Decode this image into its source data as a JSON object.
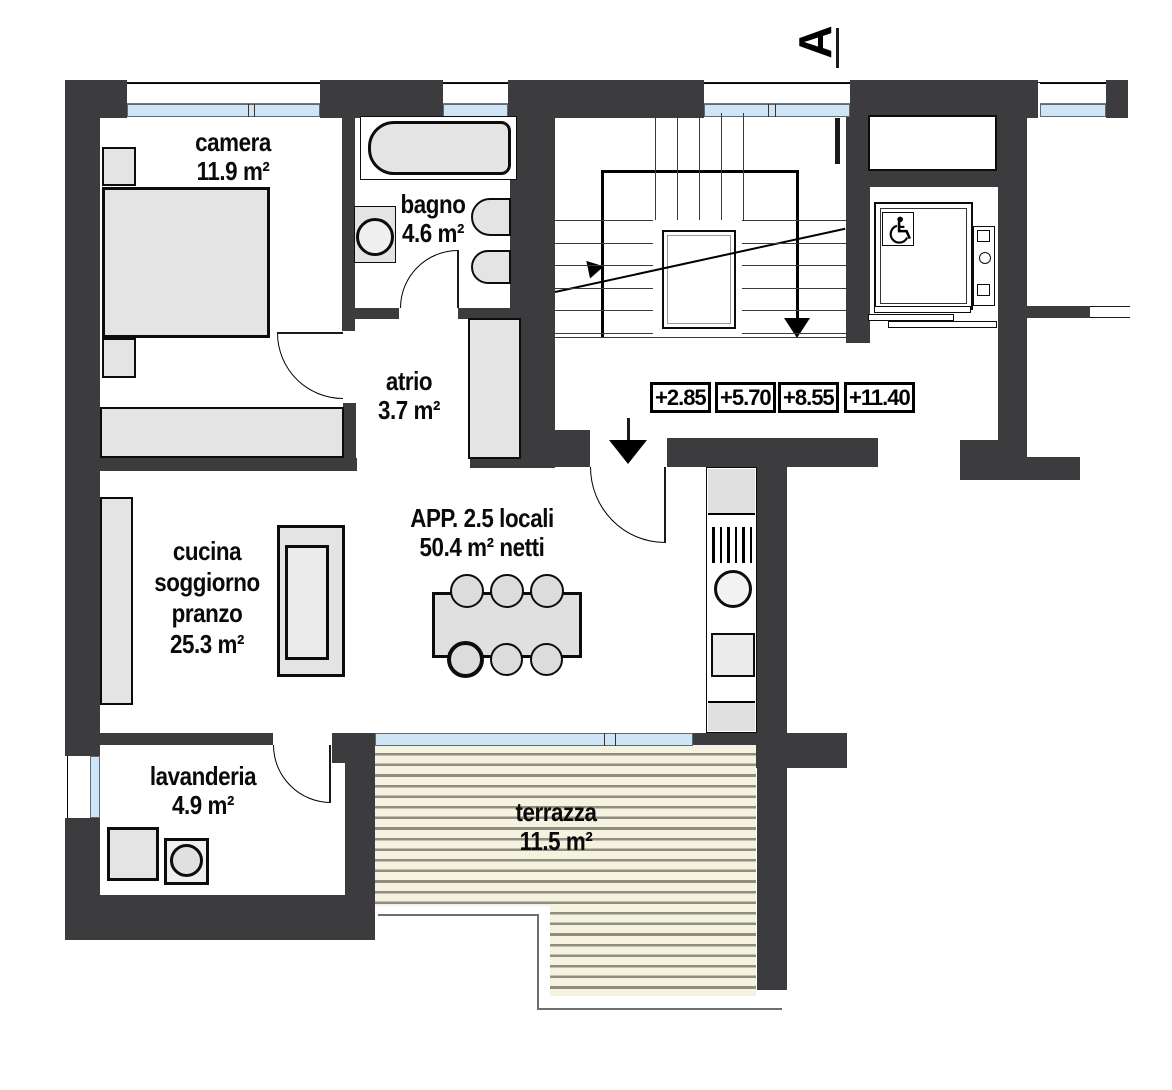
{
  "apartment": {
    "line1": "APP. 2.5 locali",
    "line2": "50.4 m² netti"
  },
  "rooms": {
    "camera": {
      "name": "camera",
      "area": "11.9 m²"
    },
    "bagno": {
      "name": "bagno",
      "area": "4.6 m²"
    },
    "atrio": {
      "name": "atrio",
      "area": "3.7 m²"
    },
    "cucina": {
      "line1": "cucina",
      "line2": "soggiorno",
      "line3": "pranzo",
      "area": "25.3 m²"
    },
    "lavanderia": {
      "name": "lavanderia",
      "area": "4.9 m²"
    },
    "terrazza": {
      "name": "terrazza",
      "area": "11.5 m²"
    }
  },
  "levels": {
    "values": [
      "+2.85",
      "+5.70",
      "+8.55",
      "+11.40"
    ]
  },
  "section": {
    "label": "A"
  },
  "colors": {
    "wall": "#3c3c3e",
    "window": "#cfe4f4",
    "furniture": "#e4e4e4",
    "terrace": "#f5f2df",
    "terrace_stripe": "#8f8e80"
  }
}
